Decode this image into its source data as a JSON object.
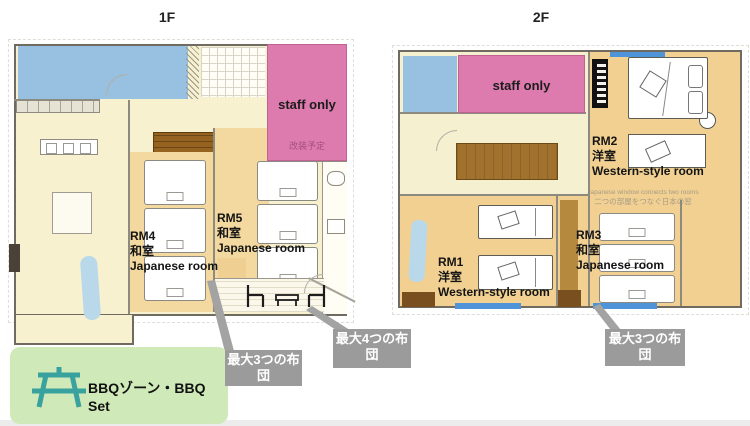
{
  "floors": {
    "f1": {
      "title": "1F",
      "staff_label": "staff only",
      "staff_note": "改装予定",
      "rooms": {
        "rm4": {
          "id": "RM4",
          "jp": "和室",
          "en": "Japanese room"
        },
        "rm5": {
          "id": "RM5",
          "jp": "和室",
          "en": "Japanese room"
        }
      },
      "callouts": {
        "futon3": {
          "full": "最大3つの布団",
          "line1": "最大3つの布",
          "line2": "団"
        },
        "futon4": {
          "full": "最大4つの布団",
          "line1": "最大4つの布",
          "line2": "団"
        }
      },
      "bbq_label": "BBQゾーン・BBQ Set"
    },
    "f2": {
      "title": "2F",
      "staff_label": "staff only",
      "rooms": {
        "rm1": {
          "id": "RM1",
          "jp": "洋室",
          "en": "Western-style room"
        },
        "rm2": {
          "id": "RM2",
          "jp": "洋室",
          "en": "Western-style room"
        },
        "rm3": {
          "id": "RM3",
          "jp": "和室",
          "en": "Japanese room"
        }
      },
      "callouts": {
        "futon3": {
          "full": "最大3つの布団",
          "line1": "最大3つの布",
          "line2": "団"
        }
      },
      "window_note": {
        "en": "Japanese window connects two rooms",
        "jp": "二つの部屋をつなぐ日本の窓"
      }
    }
  },
  "colors": {
    "staff_pink": "#dd7aae",
    "wet_area_blue": "#7db2e6",
    "floor_cream": "#f7f1cf",
    "tatami_orange": "#f1d092",
    "stair_brown": "#96621f",
    "bbq_green": "#cfe9b8",
    "bbq_icon_teal": "#3aa29e",
    "callout_gray": "#9b9b9b",
    "window_blue": "#4f94d8"
  },
  "icons": {
    "bbq": "picnic-table-icon"
  }
}
